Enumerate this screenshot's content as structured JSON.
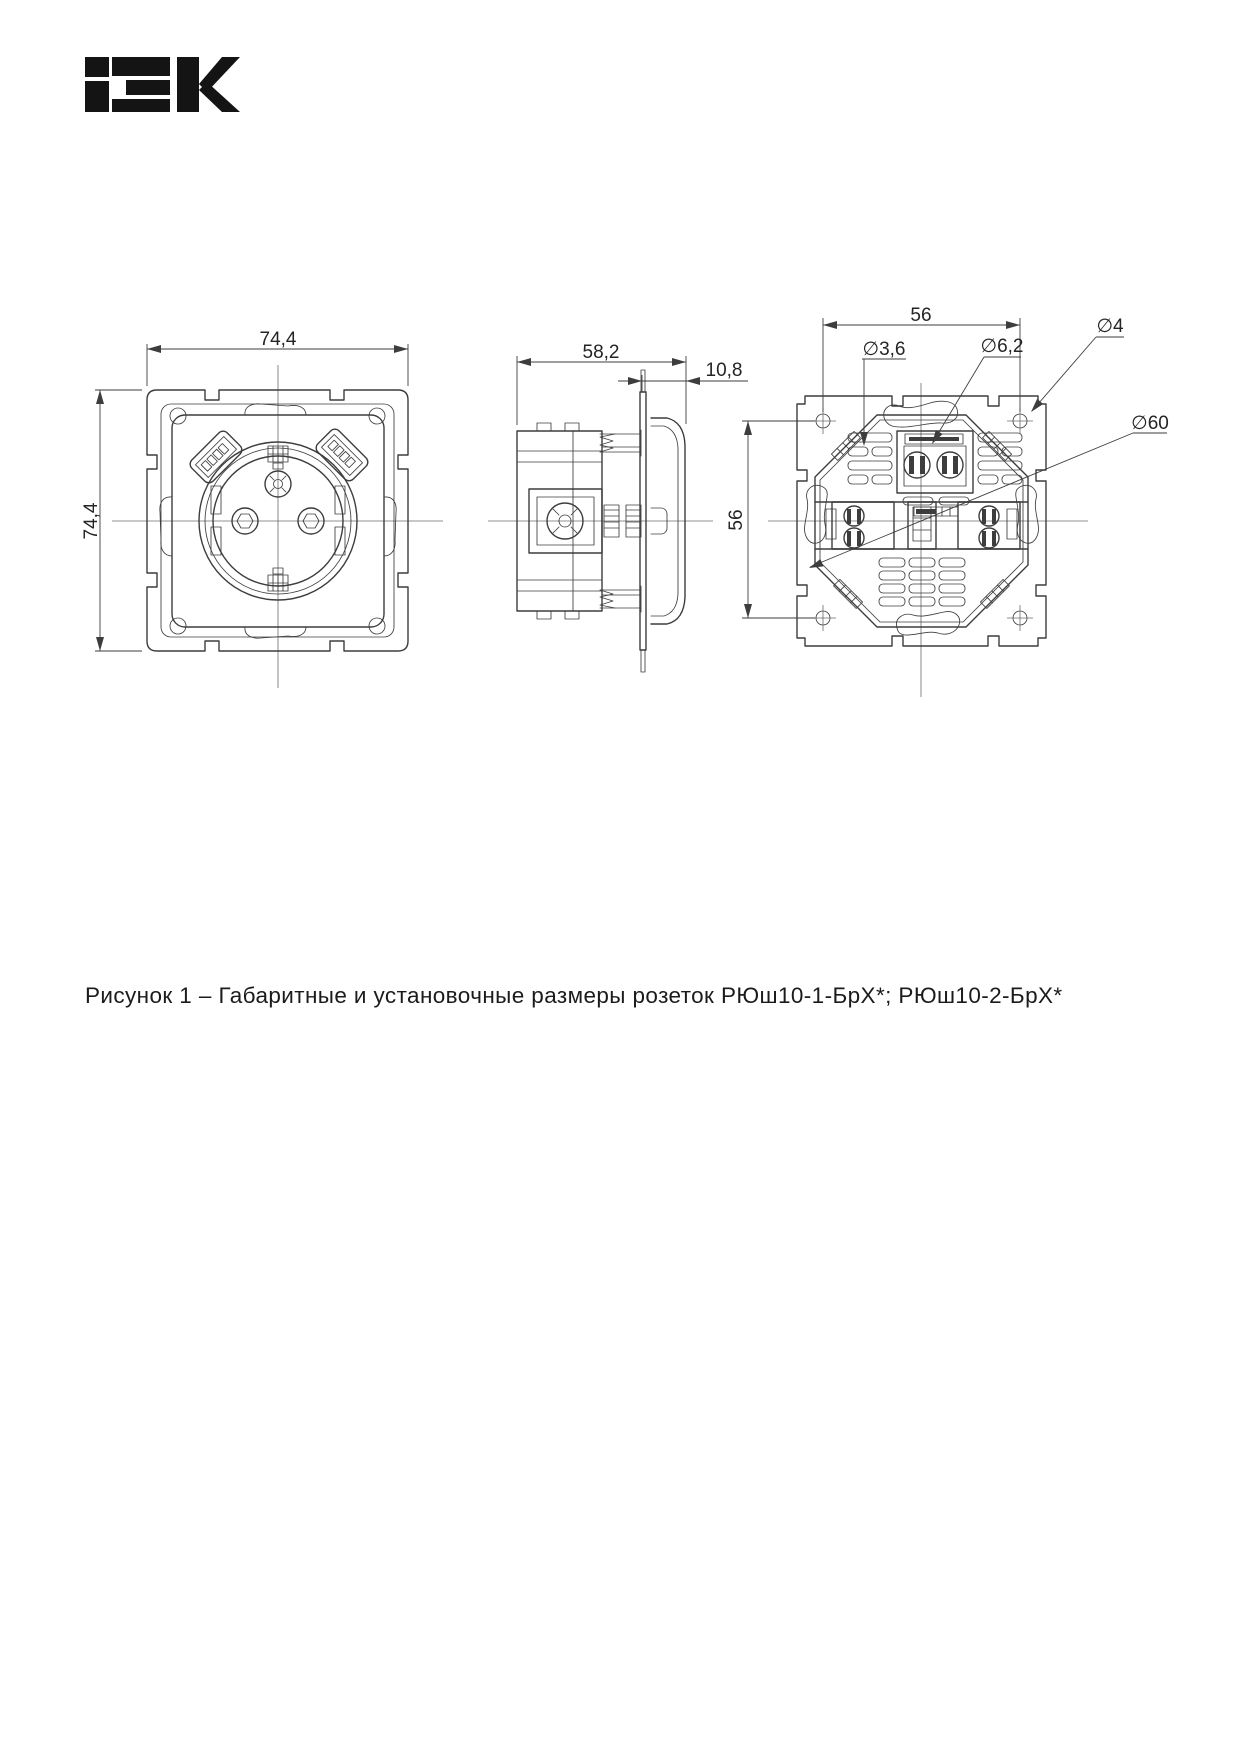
{
  "page": {
    "background": "#ffffff",
    "ink_color": "#3d3d3d",
    "text_color": "#1b1b1b"
  },
  "logo": {
    "brand": "IEK",
    "color": "#141414"
  },
  "figure": {
    "front_view": {
      "width_label": "74,4",
      "height_label": "74,4"
    },
    "side_view": {
      "depth_label": "58,2",
      "cover_thickness_label": "10,8"
    },
    "back_view": {
      "hole_spacing_horizontal_label": "56",
      "hole_spacing_vertical_label": "56",
      "claw_hole_diameter_label": "∅3,6",
      "terminal_screw_diameter_label": "∅6,2",
      "mounting_hole_diameter_label": "∅4",
      "body_diameter_label": "∅60"
    }
  },
  "caption": {
    "text": "Рисунок 1 – Габаритные и установочные размеры розеток РЮш10-1-БрХ*; РЮш10-2-БрХ*"
  }
}
